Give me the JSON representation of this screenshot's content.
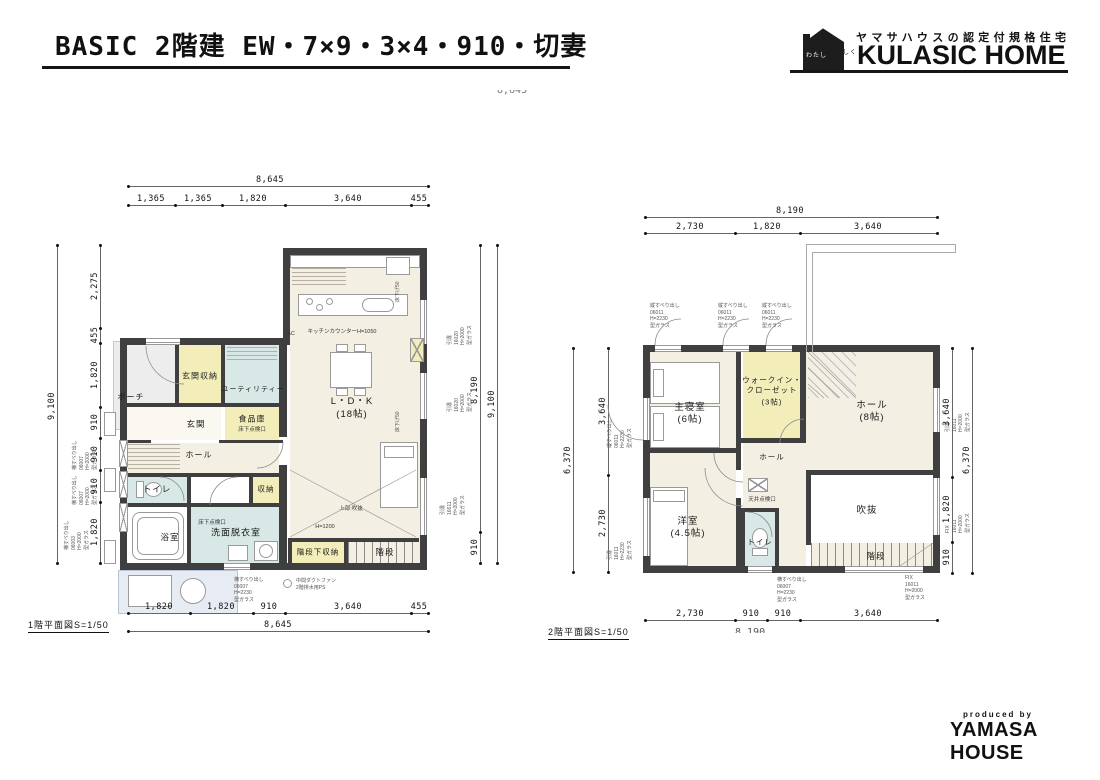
{
  "header": {
    "title": "BASIC 2階建 EW・7×9・3×4・910・切妻",
    "logo": {
      "mark_line1": "わたし",
      "mark_line2": "らしく",
      "tagline": "ヤマサハウスの認定付規格住宅",
      "brand": "KULASIC HOME"
    },
    "clipped_dim": "8,645"
  },
  "footer": {
    "produced_by": "produced by",
    "brand": "YAMASA HOUSE"
  },
  "floor1": {
    "caption": "1階平面図S=1/50",
    "dims": {
      "top_total": "8,645",
      "top_segs": [
        "1,365",
        "1,365",
        "1,820",
        "3,640",
        "455"
      ],
      "bottom_segs": [
        "1,820",
        "1,820",
        "910",
        "3,640",
        "455"
      ],
      "bottom_total": "8,645",
      "left_total": "9,100",
      "left_segs": [
        "2,275",
        "455",
        "1,820",
        "910",
        "910",
        "910",
        "1,820"
      ],
      "right_segs": [
        "8,190",
        "910"
      ],
      "right_total": "9,100"
    },
    "rooms": {
      "porch": "ポーチ",
      "entrance": "玄関",
      "entrance_storage": "玄関収納",
      "utility": "ユーティリティー",
      "pantry": "食品庫",
      "pantry_note": "床下点検口",
      "ldk_name": "L・D・K",
      "ldk_size": "(18帖)",
      "hall": "ホール",
      "toilet": "トイレ",
      "bath": "浴室",
      "washroom": "洗面脱衣室",
      "washroom_note": "床下点検口",
      "storage": "収納",
      "under_stair_storage": "階段下収納",
      "stairs": "階段",
      "void_above": "上部:吹抜",
      "kitchen_counter": "キッチンカウンターH=1050",
      "ac": "AC",
      "h1200": "H=1200"
    },
    "window_notes": {
      "left_1": "横すべり出し\n06007\nH=2000\n型ガラス",
      "left_2": "横すべり出し\n06007\nH=2000\n型ガラス",
      "left_3": "横すべり出し\n06003\nH=2000\n型ガラス",
      "bottom_1": "横すべり出し\n06007\nH=2230\n型ガラス",
      "bottom_2": "中間ダクトファン\n2階排水用PS",
      "right_1": "引違\n16020\nH=2000\n型ガラス",
      "right_2": "引違\n16020\nH=2000\n型ガラス",
      "right_3": "引違\n16611\nH=2000\n型ガラス",
      "wall_1": "床下げ50",
      "wall_2": "床下げ50"
    }
  },
  "floor2": {
    "caption": "2階平面図S=1/50",
    "clipped_bottom_total": "8,190",
    "dims": {
      "top_total": "8,190",
      "top_segs": [
        "2,730",
        "1,820",
        "3,640"
      ],
      "bottom_segs": [
        "2,730",
        "910",
        "910",
        "3,640"
      ],
      "left_total": "6,370",
      "left_segs": [
        "3,640",
        "2,730"
      ],
      "right_total": "6,370",
      "right_segs": [
        "3,640",
        "1,820",
        "910"
      ]
    },
    "rooms": {
      "master_name": "主寝室",
      "master_size": "(6帖)",
      "wic_line1": "ウォークイン・",
      "wic_line2": "クローゼット",
      "wic_size": "(3帖)",
      "hall_name": "ホール",
      "hall_size": "(8帖)",
      "hall_small": "ホール",
      "ceiling_hatch": "天井点検口",
      "western_name": "洋室",
      "western_size": "(4.5帖)",
      "toilet": "トイレ",
      "void": "吹抜",
      "stairs": "階段"
    },
    "window_notes": {
      "top_1": "縦すべり出し\n06011\nH=2230\n型ガラス",
      "top_2": "縦すべり出し\n06011\nH=2230\n型ガラス",
      "top_3": "縦すべり出し\n06011\nH=2230\n型ガラス",
      "left_1": "縦すべり出し\n06011\nH=2230\n型ガラス",
      "left_2": "引違\n16011\nH=2230\n型ガラス",
      "right_1": "引違\n16011\nH=2000\n型ガラス",
      "right_2": "FIX\n16011\nH=2000\n型ガラス",
      "bottom_1": "横すべり出し\n06007\nH=2230\n型ガラス",
      "bottom_2": "FIX\n16011\nH=2000\n型ガラス"
    }
  },
  "colors": {
    "wall": "#3f3f3f",
    "floor_cream": "#f4efe3",
    "storage_yellow": "#f2edb9",
    "wet_blue": "#d7e8e6",
    "porch_gray": "#ededed"
  }
}
